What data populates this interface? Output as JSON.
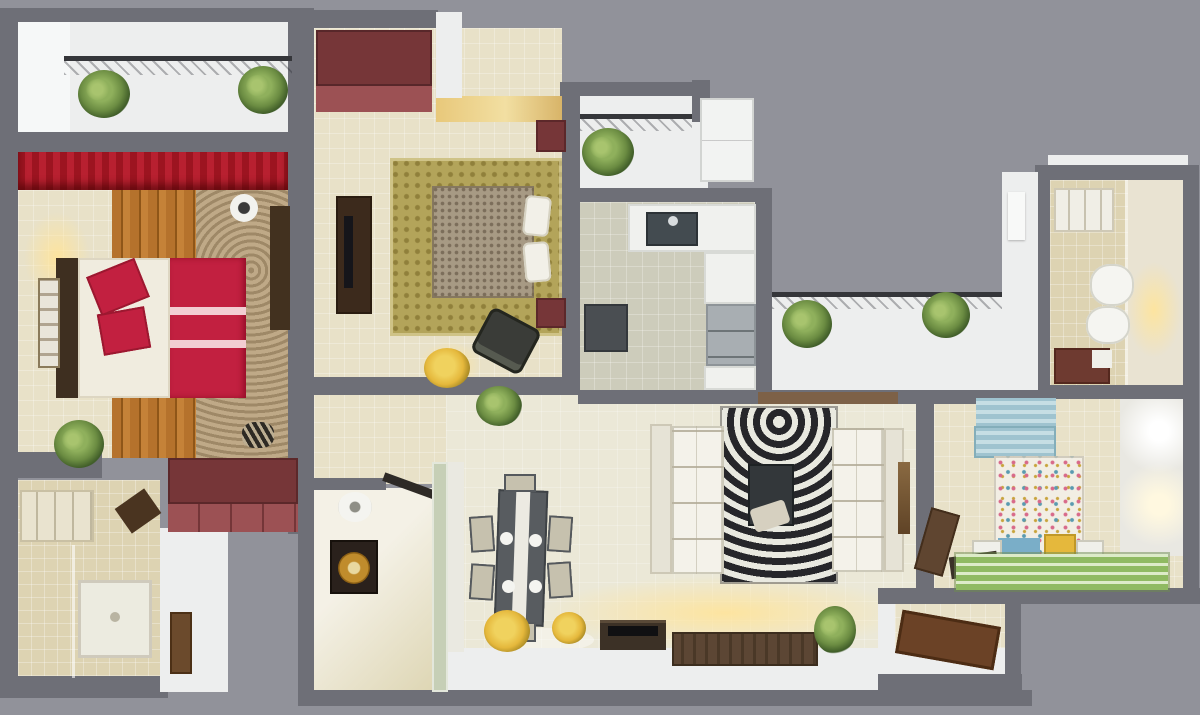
{
  "scene": {
    "kind": "3d-floor-plan-render",
    "view": "top-down-isometric",
    "rooms": [
      {
        "id": "balcony-top-left"
      },
      {
        "id": "master-bedroom"
      },
      {
        "id": "bathroom-bottom-left"
      },
      {
        "id": "second-bedroom"
      },
      {
        "id": "entry-balcony"
      },
      {
        "id": "kitchen"
      },
      {
        "id": "kitchen-balcony"
      },
      {
        "id": "bathroom-top-right"
      },
      {
        "id": "kids-bedroom"
      },
      {
        "id": "living-dining-room"
      },
      {
        "id": "utility-room"
      },
      {
        "id": "entrance-foyer"
      }
    ],
    "furniture": [
      {
        "id": "master-bed",
        "room": "master-bedroom"
      },
      {
        "id": "master-wardrobe",
        "room": "master-bedroom"
      },
      {
        "id": "double-bed",
        "room": "second-bedroom"
      },
      {
        "id": "tv-cabinet",
        "room": "second-bedroom"
      },
      {
        "id": "l-shaped-counter",
        "room": "kitchen"
      },
      {
        "id": "fridge",
        "room": "kitchen"
      },
      {
        "id": "toilet",
        "room": "bathroom-top-right"
      },
      {
        "id": "bidet",
        "room": "bathroom-top-right"
      },
      {
        "id": "kids-bed",
        "room": "kids-bedroom"
      },
      {
        "id": "sofa-left",
        "room": "living-dining-room"
      },
      {
        "id": "sofa-right",
        "room": "living-dining-room"
      },
      {
        "id": "zebra-rug",
        "room": "living-dining-room"
      },
      {
        "id": "coffee-table",
        "room": "living-dining-room"
      },
      {
        "id": "dining-table",
        "room": "living-dining-room"
      },
      {
        "id": "tv-console",
        "room": "living-dining-room"
      },
      {
        "id": "shower",
        "room": "bathroom-bottom-left"
      }
    ]
  },
  "palette": {
    "bg": "#91929a",
    "wall": "#6e6f77",
    "whiteFace": "#edeeee",
    "floorBeige": "#e8e1c8",
    "floorBath": "#ddd3b2",
    "floorGray": "#cdccbb",
    "floorCream": "#ebe8d7",
    "wood": "#b5722c",
    "woodDark": "#8f5618",
    "canopyRed": "#9c1420",
    "bedRed": "#c22040",
    "maroonDark": "#763638",
    "maroonLight": "#9c5154",
    "sheetWhite": "#f0ecdf",
    "rugOlive": "#b3a45a",
    "bedTexture": "#a79a84",
    "darkWood": "#3e2f20",
    "sofaWhite": "#f4f2ea",
    "zebraDark": "#26262a",
    "zebraLight": "#e9e9e0",
    "tableGray": "#585c60",
    "chairBeige": "#c6c1ae",
    "kidsBlue": "#9fc3cf",
    "kidsQuilt": "#f2eee4",
    "rugGreen": "#8fba62",
    "rugGreenLight": "#dcebc8",
    "yellowAccent": "#e5b83c",
    "fridgeGray": "#a8aeb2",
    "counterWhite": "#f0f1ee",
    "sinkDark": "#434b50",
    "bathAccent": "#6e3a30",
    "plantGreen": "#6b8c42",
    "glowWarm": "#ffe49a",
    "doorBrown": "#6b4a2c",
    "glassGreen": "#c6cfb6",
    "consoleWood": "#5c4634"
  }
}
